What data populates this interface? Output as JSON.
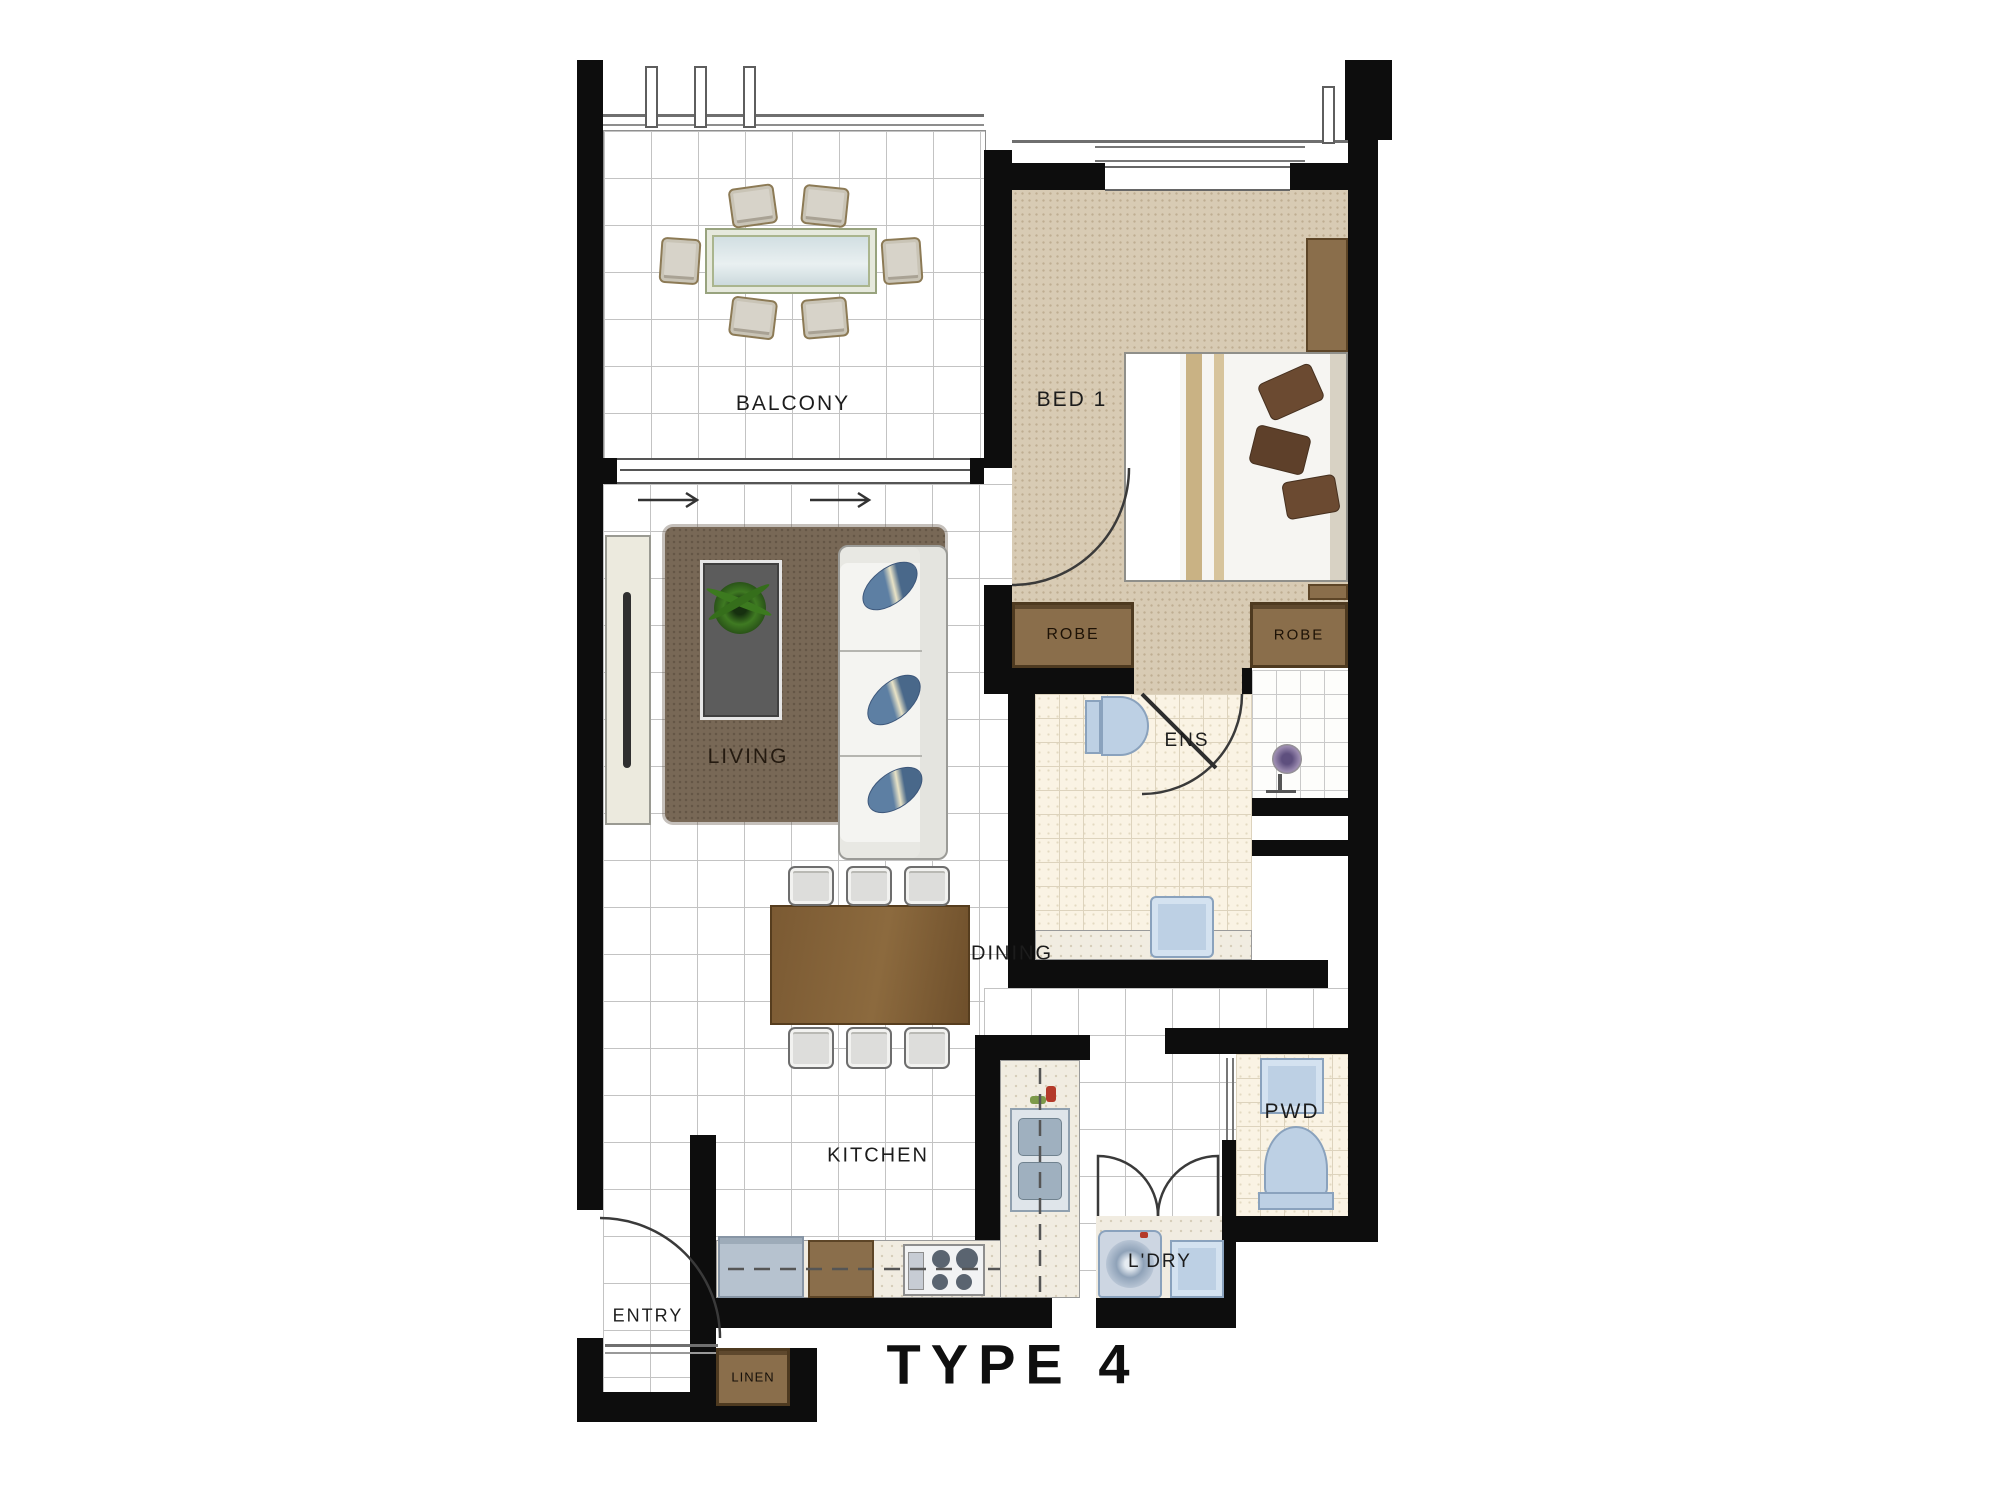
{
  "title": {
    "label": "TYPE 4"
  },
  "rooms": {
    "balcony": {
      "label": "BALCONY"
    },
    "bed1": {
      "label": "BED 1"
    },
    "living": {
      "label": "LIVING"
    },
    "robe_left": {
      "label": "ROBE"
    },
    "robe_right": {
      "label": "ROBE"
    },
    "ens": {
      "label": "ENS"
    },
    "dining": {
      "label": "DINING"
    },
    "kitchen": {
      "label": "KITCHEN"
    },
    "pwd": {
      "label": "PWD"
    },
    "laundry": {
      "label": "L'DRY"
    },
    "entry": {
      "label": "ENTRY"
    },
    "linen": {
      "label": "LINEN"
    }
  },
  "colors": {
    "wall": "#0d0d0d",
    "carpet": "#d8cbb4",
    "robe": "#8a6e4b",
    "rug": "#786856",
    "wood": "#7b5a33",
    "fixture_blue": "#bdd0e4",
    "tile_line": "#c3c3c3"
  }
}
